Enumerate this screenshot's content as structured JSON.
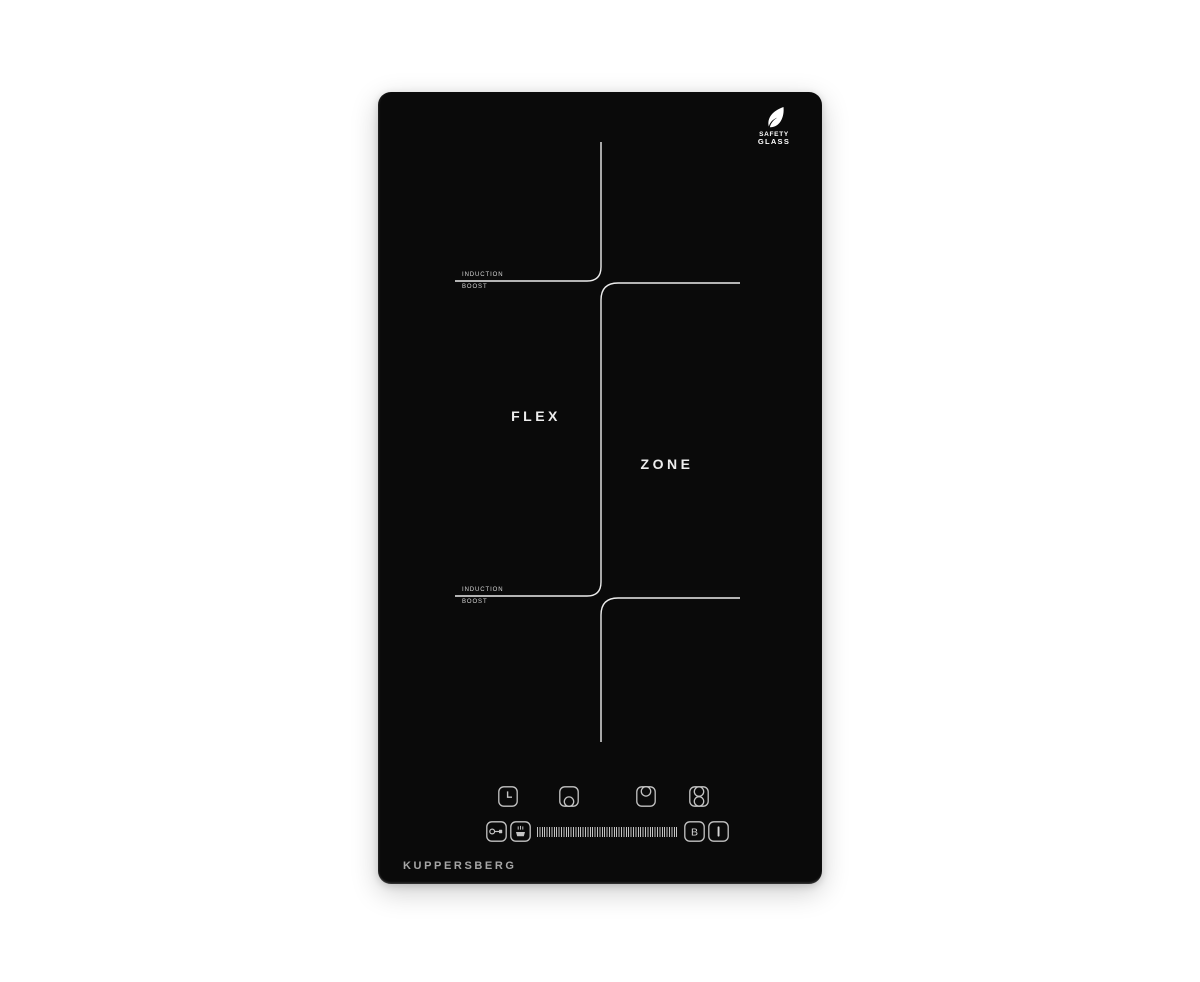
{
  "colors": {
    "page_background": "#ffffff",
    "panel": "#0a0a0a",
    "zone_lines": "#ececec",
    "control_strokes": "#c4c4c4",
    "brand_text": "#a6a6a6",
    "badge_text": "#ffffff"
  },
  "cooktop": {
    "brand": "KUPPERSBERG",
    "flex_label": "FLEX",
    "zone_label": "ZONE",
    "safety_badge": {
      "icon": "leaf-icon",
      "line1": "SAFETY",
      "line2": "GLASS"
    },
    "markings": {
      "top": {
        "line1": "INDUCTION",
        "line2": "BOOST"
      },
      "bottom": {
        "line1": "INDUCTION",
        "line2": "BOOST"
      }
    },
    "controls": {
      "icons_row": [
        {
          "name": "timer-clock-icon"
        },
        {
          "name": "front-zone-icon"
        },
        {
          "name": "rear-zone-icon"
        },
        {
          "name": "flex-bridge-zones-icon"
        }
      ],
      "lock_icon": "key-lock-icon",
      "keep_warm_icon": "keep-warm-icon",
      "slider_icon": "power-level-slider",
      "boost_button_label": "B",
      "power_button_label": "I"
    }
  }
}
